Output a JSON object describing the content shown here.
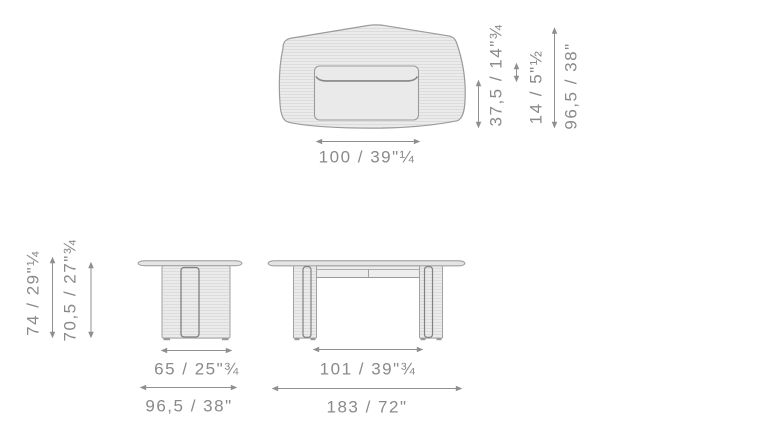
{
  "colors": {
    "background": "#ffffff",
    "outline": "#9b9b9b",
    "panel_outline": "#7f7f7f",
    "fill": "#ebebeb",
    "hatch_line": "#d6d6d6",
    "dimension": "#8a8a8a"
  },
  "views": {
    "top": {
      "width": "100 / 39\"¼",
      "drawer_depth": "37,5 / 14\"¾",
      "edge_offset": "14 / 5\"½",
      "depth": "96,5 / 38\""
    },
    "front": {
      "height": "74 / 29\"¼",
      "clearance": "70,5 / 27\"¾",
      "base_width": "65 / 25\"¾",
      "top_width": "96,5 / 38\""
    },
    "side": {
      "inner_span": "101 / 39\"¾",
      "length": "183 / 72\""
    }
  }
}
